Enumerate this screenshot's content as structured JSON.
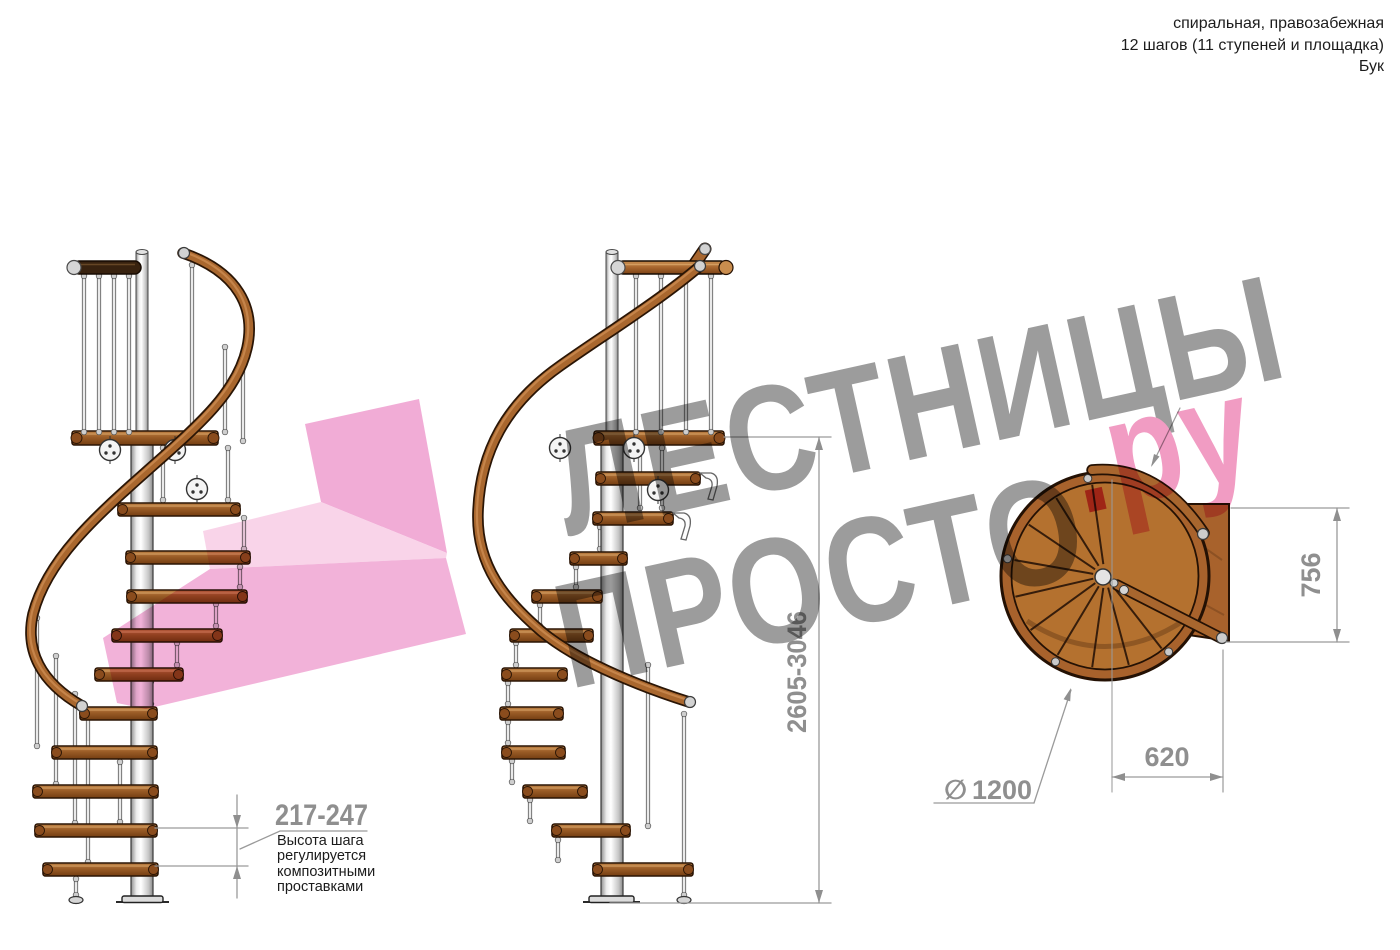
{
  "header": {
    "line1": "спиральная, правозабежная",
    "line2": "12 шагов (11 ступеней и площадка)",
    "line3": "Бук"
  },
  "watermark": {
    "line1": "ЛЕСТНИЦЫ",
    "line2": "ПРОСТО",
    "dot": ".",
    "suffix": "ру"
  },
  "dimensions": {
    "total_height": {
      "value": "2605-3046"
    },
    "platform_depth": {
      "value": "756"
    },
    "platform_width": {
      "value": "620"
    },
    "diameter": {
      "symbol": "∅",
      "value": "1200"
    },
    "step_height": {
      "value": "217-247",
      "note_lines": [
        "Высота шага",
        "регулируется",
        "композитными",
        "проставками"
      ]
    }
  },
  "colors": {
    "wood": "#9a5c26",
    "wood_light": "#c08347",
    "wood_dark": "#7c4315",
    "outline": "#2b1505",
    "steel": "#e9e9e9",
    "dimension_gray": "#8f8f8f",
    "text": "#1d1d1d",
    "watermark_gray": "#9c9c9c",
    "watermark_pink": "#f19cc3",
    "watermark_dot": "#e25377",
    "arrow_pink": "#f0a3d2"
  }
}
